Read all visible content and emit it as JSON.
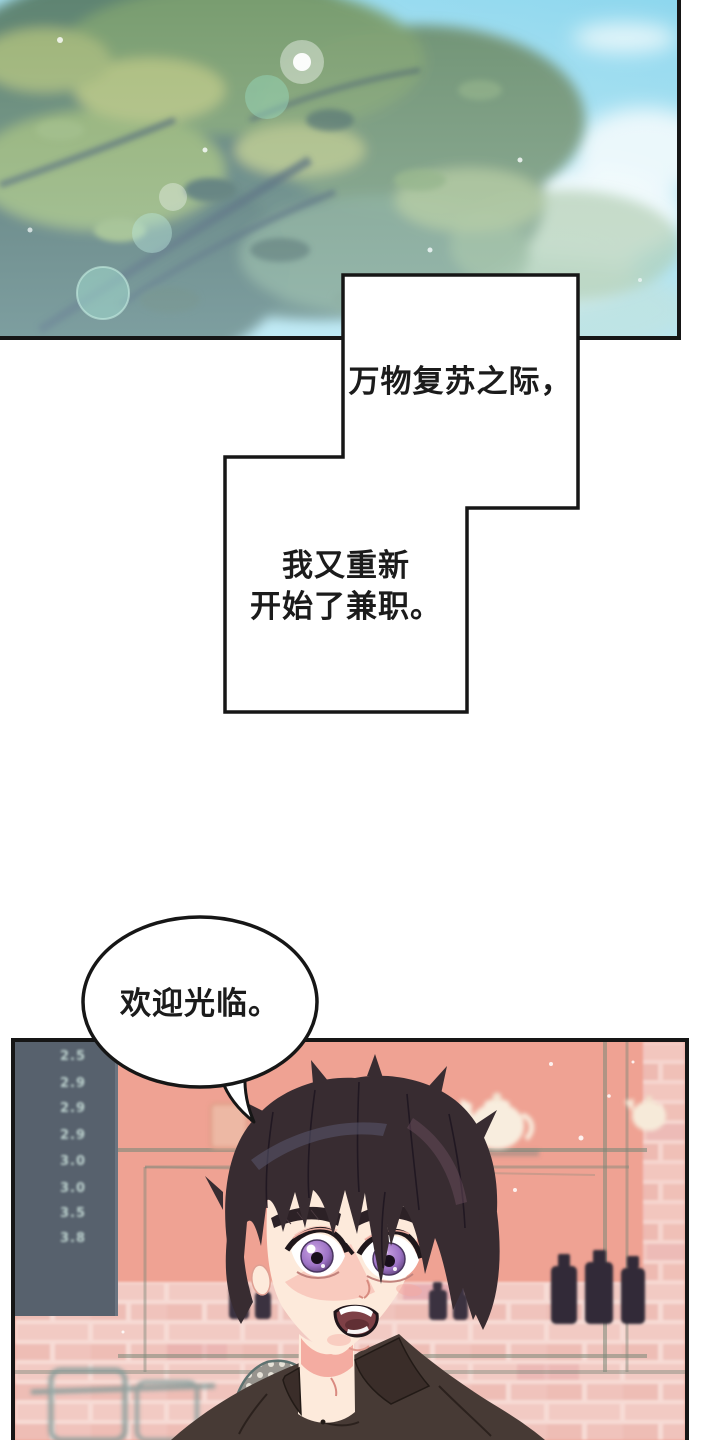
{
  "narration": {
    "box1": "万物复苏之际，",
    "box2_line1": "我又重新",
    "box2_line2": "开始了兼职。"
  },
  "dialogue": {
    "greeting": "欢迎光临。"
  },
  "cafe": {
    "menu_board_prices": [
      "2.5",
      "2.9",
      "2.9",
      "2.9",
      "3.0",
      "3.0",
      "3.5",
      "3.8"
    ]
  },
  "colors": {
    "panel_border": "#161616",
    "sky_light": "#c2ecf6",
    "sky_deep": "#8ed7ee",
    "foliage_dark": "#4f7270",
    "foliage_light": "#8fae72",
    "cafe_wall": "#efa293",
    "brick_light": "#f2cac3",
    "menu_board": "#57616d",
    "menu_text": "#c8ded9",
    "hair": "#382c31",
    "skin": "#fdeadb",
    "blush": "#f5aaa2",
    "iris_purple": "#9e73c6",
    "shirt": "#473a35",
    "teapot": "#f8edde",
    "bottle": "#3a3340"
  }
}
